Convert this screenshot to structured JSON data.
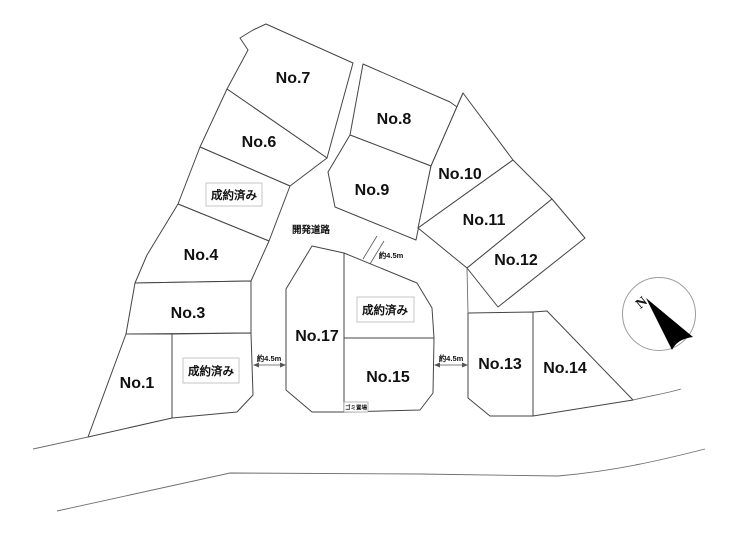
{
  "lots": {
    "no1": "No.1",
    "no3": "No.3",
    "no4": "No.4",
    "no6": "No.6",
    "no7": "No.7",
    "no8": "No.8",
    "no9": "No.9",
    "no10": "No.10",
    "no11": "No.11",
    "no12": "No.12",
    "no13": "No.13",
    "no14": "No.14",
    "no15": "No.15",
    "no17": "No.17"
  },
  "sold": {
    "lot5": "成約済み",
    "lot2": "成約済み",
    "lot16": "成約済み"
  },
  "road": {
    "name": "開発道路",
    "width_upper": "約4.5m",
    "width_left": "約4.5m",
    "width_right": "約4.5m"
  },
  "facilities": {
    "garbage": "ゴミ置場"
  },
  "compass": {
    "north": "N"
  },
  "colors": {
    "line": "#454545",
    "sold_border": "#c6c6c6",
    "road_line": "#6e6e6e",
    "needle": "#000000",
    "background": "#ffffff"
  }
}
